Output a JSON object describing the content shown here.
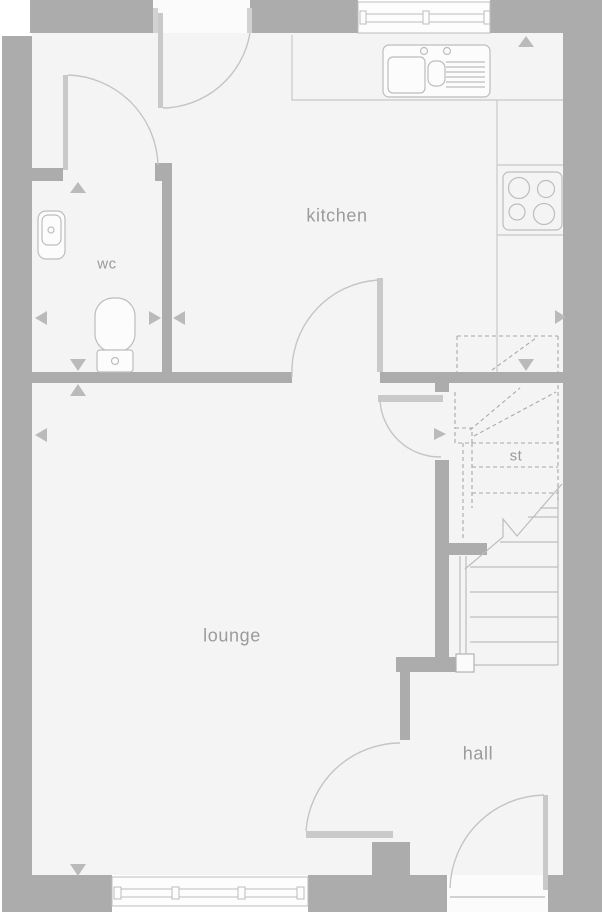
{
  "plan": {
    "type": "floor-plan",
    "rooms": [
      {
        "id": "kitchen",
        "label": "kitchen"
      },
      {
        "id": "wc",
        "label": "wc"
      },
      {
        "id": "lounge",
        "label": "lounge"
      },
      {
        "id": "store",
        "label": "st"
      },
      {
        "id": "hall",
        "label": "hall"
      }
    ],
    "fixtures": [
      "kitchen-window",
      "rear-door",
      "sink-and-drainer",
      "hob",
      "wash-basin",
      "toilet",
      "wc-door",
      "kitchen-lounge-door",
      "kitchen-hall-door",
      "staircase",
      "under-stairs-store",
      "lounge-hall-door",
      "lounge-window",
      "front-door"
    ],
    "colors": {
      "wall": "#acacac",
      "floor": "#f4f4f4",
      "opening": "#fbfbfb",
      "fixture_line": "#bdbdbd",
      "door_leaf": "#c9c9c9",
      "dashed_line": "#a9a9a9",
      "label_text": "#9b9b9b"
    }
  }
}
